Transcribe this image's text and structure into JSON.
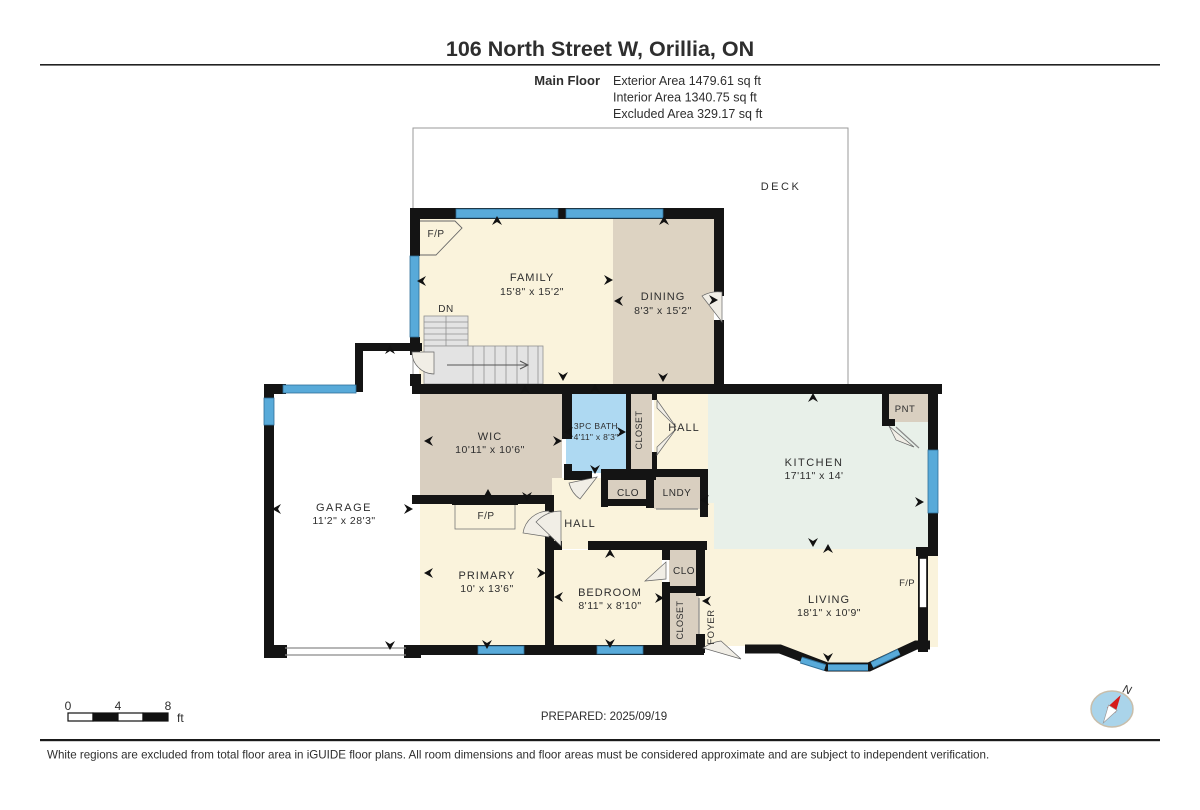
{
  "header": {
    "title": "106 North Street W, Orillia, ON",
    "floor_label": "Main Floor",
    "areas": [
      "Exterior Area 1479.61 sq ft",
      "Interior Area 1340.75 sq ft",
      "Excluded Area 329.17 sq ft"
    ]
  },
  "footer": {
    "prepared": "PREPARED: 2025/09/19",
    "disclaimer": "White regions are excluded from total floor area in iGUIDE floor plans. All room dimensions and floor areas must be considered approximate and are subject to independent verification.",
    "scale_labels": [
      "0",
      "4",
      "8"
    ],
    "scale_unit": "ft",
    "compass_n": "N"
  },
  "colors": {
    "wall": "#141414",
    "cream": "#faf3dc",
    "tan": "#ddd3c2",
    "tan2": "#d9cfc0",
    "bath": "#aed9f2",
    "mint": "#e8f0e9",
    "stair": "#e3e3e3",
    "window": "#58aad9",
    "windowEdge": "#2f6f98",
    "door": "#f1eee6",
    "doorEdge": "#666666",
    "thin": "#8a8a8a",
    "deckEdge": "#9a9a9a",
    "text": "#3a3a3a"
  },
  "floorplan": {
    "deck": [
      413,
      128,
      435,
      258
    ],
    "fills": [
      {
        "n": "family",
        "x": 419,
        "y": 219,
        "w": 195,
        "h": 165,
        "c": "cream"
      },
      {
        "n": "dining",
        "x": 613,
        "y": 219,
        "w": 101,
        "h": 165,
        "c": "tan"
      },
      {
        "n": "wic",
        "x": 420,
        "y": 394,
        "w": 142,
        "h": 101,
        "c": "tan2"
      },
      {
        "n": "bath",
        "x": 566,
        "y": 394,
        "w": 60,
        "h": 79,
        "c": "bath"
      },
      {
        "n": "closet-bath",
        "x": 631,
        "y": 394,
        "w": 21,
        "h": 79,
        "c": "tan2"
      },
      {
        "n": "hall-upper",
        "x": 654,
        "y": 394,
        "w": 54,
        "h": 84,
        "c": "cream"
      },
      {
        "n": "kitchen",
        "x": 708,
        "y": 394,
        "w": 230,
        "h": 155,
        "c": "mint"
      },
      {
        "n": "pantry",
        "x": 884,
        "y": 394,
        "w": 46,
        "h": 28,
        "c": "tan2"
      },
      {
        "n": "hall-lower-a",
        "x": 552,
        "y": 478,
        "w": 50,
        "h": 25,
        "c": "cream"
      },
      {
        "n": "hall-lower",
        "x": 550,
        "y": 503,
        "w": 164,
        "h": 46,
        "c": "cream"
      },
      {
        "n": "clo-hall",
        "x": 606,
        "y": 477,
        "w": 42,
        "h": 25,
        "c": "tan2"
      },
      {
        "n": "laundry",
        "x": 654,
        "y": 477,
        "w": 46,
        "h": 32,
        "c": "tan2"
      },
      {
        "n": "primary",
        "x": 420,
        "y": 503,
        "w": 125,
        "h": 150,
        "c": "cream"
      },
      {
        "n": "bedroom",
        "x": 552,
        "y": 550,
        "w": 110,
        "h": 103,
        "c": "cream"
      },
      {
        "n": "living-foyer",
        "pts": "670,549 938,549 938,647 915,647 868,669 826,669 778,650 745,650 745,646 670,646",
        "c": "cream"
      },
      {
        "n": "clo-bedroom",
        "x": 669,
        "y": 550,
        "w": 30,
        "h": 38,
        "c": "tan2"
      },
      {
        "n": "closet-foyer",
        "x": 669,
        "y": 593,
        "w": 30,
        "h": 52,
        "c": "tan2"
      },
      {
        "n": "fp-primary-box",
        "x": 455,
        "y": 504,
        "w": 60,
        "h": 25,
        "c": "cream"
      }
    ],
    "walls": [
      [
        410,
        208,
        314,
        11
      ],
      [
        410,
        208,
        10,
        48
      ],
      [
        410,
        337,
        10,
        18
      ],
      [
        410,
        374,
        11,
        12
      ],
      [
        355,
        343,
        67,
        8
      ],
      [
        355,
        343,
        8,
        49
      ],
      [
        264,
        384,
        22,
        10
      ],
      [
        264,
        384,
        10,
        274
      ],
      [
        264,
        645,
        23,
        13
      ],
      [
        404,
        645,
        17,
        13
      ],
      [
        412,
        384,
        530,
        10
      ],
      [
        714,
        208,
        10,
        88
      ],
      [
        714,
        320,
        10,
        72
      ],
      [
        928,
        384,
        10,
        66
      ],
      [
        928,
        513,
        10,
        42
      ],
      [
        916,
        547,
        22,
        9
      ],
      [
        918,
        553,
        10,
        99
      ],
      [
        412,
        645,
        292,
        10
      ],
      [
        562,
        384,
        10,
        55
      ],
      [
        564,
        464,
        8,
        14
      ],
      [
        564,
        471,
        28,
        9
      ],
      [
        608,
        471,
        48,
        9
      ],
      [
        626,
        388,
        5,
        85
      ],
      [
        652,
        388,
        5,
        12
      ],
      [
        652,
        452,
        5,
        22
      ],
      [
        601,
        469,
        7,
        38
      ],
      [
        601,
        469,
        106,
        8
      ],
      [
        646,
        469,
        8,
        39
      ],
      [
        700,
        469,
        8,
        48
      ],
      [
        601,
        499,
        53,
        7
      ],
      [
        412,
        495,
        142,
        9
      ],
      [
        452,
        497,
        66,
        8
      ],
      [
        545,
        495,
        9,
        17
      ],
      [
        545,
        536,
        9,
        117
      ],
      [
        545,
        541,
        17,
        9
      ],
      [
        588,
        541,
        119,
        9
      ],
      [
        662,
        544,
        8,
        16
      ],
      [
        662,
        582,
        8,
        71
      ],
      [
        696,
        541,
        9,
        55
      ],
      [
        668,
        586,
        31,
        7
      ],
      [
        696,
        634,
        9,
        19
      ],
      [
        882,
        391,
        7,
        34
      ],
      [
        882,
        419,
        13,
        7
      ]
    ],
    "windows": [
      [
        456,
        209,
        102,
        9
      ],
      [
        566,
        209,
        97,
        9
      ],
      [
        410,
        256,
        9,
        81
      ],
      [
        283,
        385,
        73,
        8
      ],
      [
        264,
        398,
        10,
        27
      ],
      [
        928,
        450,
        10,
        63
      ],
      [
        478,
        646,
        46,
        8
      ],
      [
        597,
        646,
        46,
        8
      ]
    ],
    "white_patches": [
      {
        "n": "deck-door-opening",
        "x": 714,
        "y": 296,
        "w": 10,
        "h": 24
      },
      {
        "n": "fireplace-notch",
        "x": 919,
        "y": 558,
        "w": 8,
        "h": 50,
        "stroke": true
      }
    ],
    "bay": {
      "wall": "M745,649 L780,649 L827,667 L869,667 L916,645 L930,645",
      "wins": [
        [
          801,
          660,
          825,
          667.5
        ],
        [
          828,
          667.5,
          868,
          667.5
        ],
        [
          872,
          665,
          899,
          652
        ]
      ]
    },
    "stairs": {
      "up": [
        424,
        316,
        44,
        30
      ],
      "low": [
        424,
        346,
        119,
        38
      ],
      "hlines": [
        322,
        328,
        334,
        340
      ],
      "vline": 446,
      "vlines": [
        473,
        484,
        495,
        506,
        517,
        528,
        538
      ],
      "arrow": [
        447,
        365,
        528
      ]
    },
    "thin_lines": [
      [
        285,
        648,
        406,
        648
      ],
      [
        285,
        655,
        406,
        655
      ],
      [
        656,
        509,
        698,
        509
      ],
      [
        699,
        598,
        699,
        634
      ],
      [
        896,
        427,
        919,
        448
      ]
    ],
    "fp_family": "M418,221 L455,221 L462,228 L436,255 L418,255",
    "fp_box_bar": [
      515,
      504,
      0,
      25
    ],
    "doors": [
      {
        "n": "door-dining-deck",
        "d": "M722,322 L702,296 A32,32 0 0,1 722,292 Z"
      },
      {
        "n": "door-garage-hall",
        "d": "M434,352 L412,352 A22,22 0 0,0 434,374 Z"
      },
      {
        "n": "door-closet-top",
        "d": "M657,400 L676,427 L657,408 Z"
      },
      {
        "n": "door-closet-bottom",
        "d": "M657,455 L676,429 L657,447 Z"
      },
      {
        "n": "door-bath",
        "d": "M597,477 L569,483 A28,28 0 0,0 580,499 Z"
      },
      {
        "n": "door-primary",
        "d": "M549,537 L523,533 A26,26 0 0,1 549,511 Z"
      },
      {
        "n": "door-bedroom",
        "d": "M561,546 L536,522 A35,35 0 0,1 561,511 Z"
      },
      {
        "n": "door-clo-bedroom",
        "d": "M666,562 L645,581 L666,579 Z"
      },
      {
        "n": "door-foyer-entry",
        "d": "M741,659 L703,648 A39,39 0 0,1 721,641 Z"
      },
      {
        "n": "door-pantry",
        "d": "M889,426 L914,447 L896,440 Z"
      }
    ],
    "arrows": [
      [
        497,
        222,
        "u"
      ],
      [
        664,
        222,
        "u"
      ],
      [
        423,
        281,
        "l"
      ],
      [
        607,
        280,
        "r"
      ],
      [
        620,
        301,
        "l"
      ],
      [
        563,
        375,
        "d"
      ],
      [
        663,
        376,
        "d"
      ],
      [
        712,
        300,
        "r"
      ],
      [
        390,
        351,
        "u"
      ],
      [
        278,
        509,
        "l"
      ],
      [
        407,
        509,
        "r"
      ],
      [
        390,
        644,
        "d"
      ],
      [
        525,
        391,
        "u"
      ],
      [
        430,
        441,
        "l"
      ],
      [
        556,
        441,
        "r"
      ],
      [
        527,
        495,
        "d"
      ],
      [
        570,
        432,
        "l"
      ],
      [
        620,
        432,
        "r"
      ],
      [
        595,
        390,
        "u"
      ],
      [
        595,
        468,
        "d"
      ],
      [
        813,
        399,
        "u"
      ],
      [
        918,
        502,
        "r"
      ],
      [
        813,
        541,
        "d"
      ],
      [
        828,
        550,
        "u"
      ],
      [
        828,
        656,
        "d"
      ],
      [
        706,
        500,
        "l"
      ],
      [
        488,
        495,
        "u"
      ],
      [
        430,
        573,
        "l"
      ],
      [
        540,
        573,
        "r"
      ],
      [
        487,
        643,
        "d"
      ],
      [
        610,
        555,
        "u"
      ],
      [
        560,
        597,
        "l"
      ],
      [
        658,
        598,
        "r"
      ],
      [
        610,
        642,
        "d"
      ],
      [
        708,
        601,
        "l"
      ]
    ],
    "labels": [
      {
        "n": "deck",
        "t": "DECK",
        "x": 781,
        "y": 190,
        "s": 11,
        "ls": 2.5
      },
      {
        "n": "fp-family",
        "t": "F/P",
        "x": 436,
        "y": 237,
        "s": 10,
        "ls": 0.5
      },
      {
        "n": "family",
        "t": "FAMILY",
        "x": 532,
        "y": 281,
        "s": 11,
        "ls": 1
      },
      {
        "n": "family-dims",
        "t": "15'8\" x 15'2\"",
        "x": 532,
        "y": 295,
        "s": 10.5,
        "ls": 0.5
      },
      {
        "n": "dn",
        "t": "DN",
        "x": 446,
        "y": 312,
        "s": 10,
        "ls": 0.5
      },
      {
        "n": "dining",
        "t": "DINING",
        "x": 663,
        "y": 300,
        "s": 11,
        "ls": 1
      },
      {
        "n": "dining-dims",
        "t": "8'3\" x 15'2\"",
        "x": 663,
        "y": 314,
        "s": 10.5,
        "ls": 0.5
      },
      {
        "n": "wic",
        "t": "WIC",
        "x": 490,
        "y": 440,
        "s": 11,
        "ls": 1
      },
      {
        "n": "wic-dims",
        "t": "10'11\" x 10'6\"",
        "x": 490,
        "y": 453,
        "s": 10.5,
        "ls": 0.5
      },
      {
        "n": "bath",
        "t": "3PC BATH",
        "x": 596,
        "y": 429,
        "s": 8.5,
        "ls": 0.4
      },
      {
        "n": "bath-dims",
        "t": "4'11\" x 8'3\"",
        "x": 596,
        "y": 440,
        "s": 8.5,
        "ls": 0.3
      },
      {
        "n": "closet-bath",
        "t": "CLOSET",
        "x": 642,
        "y": 430,
        "s": 9,
        "ls": 0.5,
        "r": -90
      },
      {
        "n": "hall-upper",
        "t": "HALL",
        "x": 684,
        "y": 431,
        "s": 11,
        "ls": 1
      },
      {
        "n": "kitchen",
        "t": "KITCHEN",
        "x": 814,
        "y": 466,
        "s": 11,
        "ls": 1.5
      },
      {
        "n": "kitchen-dims",
        "t": "17'11\" x 14'",
        "x": 814,
        "y": 479,
        "s": 10.5,
        "ls": 0.5
      },
      {
        "n": "pantry",
        "t": "PNT",
        "x": 905,
        "y": 412,
        "s": 9.5,
        "ls": 0.5
      },
      {
        "n": "garage",
        "t": "GARAGE",
        "x": 344,
        "y": 511,
        "s": 11,
        "ls": 1.5
      },
      {
        "n": "garage-dims",
        "t": "11'2\" x 28'3\"",
        "x": 344,
        "y": 524,
        "s": 10.5,
        "ls": 0.5
      },
      {
        "n": "clo-hall",
        "t": "CLO",
        "x": 628,
        "y": 496,
        "s": 10,
        "ls": 0.5
      },
      {
        "n": "laundry",
        "t": "LNDY",
        "x": 677,
        "y": 496,
        "s": 10,
        "ls": 0.5
      },
      {
        "n": "fp-primary",
        "t": "F/P",
        "x": 486,
        "y": 519,
        "s": 10,
        "ls": 0.5
      },
      {
        "n": "hall-lower",
        "t": "HALL",
        "x": 580,
        "y": 527,
        "s": 11,
        "ls": 1
      },
      {
        "n": "primary",
        "t": "PRIMARY",
        "x": 487,
        "y": 579,
        "s": 11,
        "ls": 1
      },
      {
        "n": "primary-dims",
        "t": "10' x 13'6\"",
        "x": 487,
        "y": 592,
        "s": 10.5,
        "ls": 0.5
      },
      {
        "n": "bedroom",
        "t": "BEDROOM",
        "x": 610,
        "y": 596,
        "s": 11,
        "ls": 1
      },
      {
        "n": "bedroom-dims",
        "t": "8'11\" x 8'10\"",
        "x": 610,
        "y": 609,
        "s": 10.5,
        "ls": 0.5
      },
      {
        "n": "clo-bedroom",
        "t": "CLO",
        "x": 684,
        "y": 574,
        "s": 10,
        "ls": 0.5
      },
      {
        "n": "closet-foyer",
        "t": "CLOSET",
        "x": 683,
        "y": 620,
        "s": 9,
        "ls": 0.5,
        "r": -90
      },
      {
        "n": "foyer",
        "t": "FOYER",
        "x": 714,
        "y": 627,
        "s": 9.5,
        "ls": 0.5,
        "r": -90
      },
      {
        "n": "living",
        "t": "LIVING",
        "x": 829,
        "y": 603,
        "s": 11,
        "ls": 1
      },
      {
        "n": "living-dims",
        "t": "18'1\" x 10'9\"",
        "x": 829,
        "y": 616,
        "s": 10.5,
        "ls": 0.5
      },
      {
        "n": "fp-living",
        "t": "F/P",
        "x": 907,
        "y": 586,
        "s": 9.5,
        "ls": 0.3
      }
    ]
  }
}
